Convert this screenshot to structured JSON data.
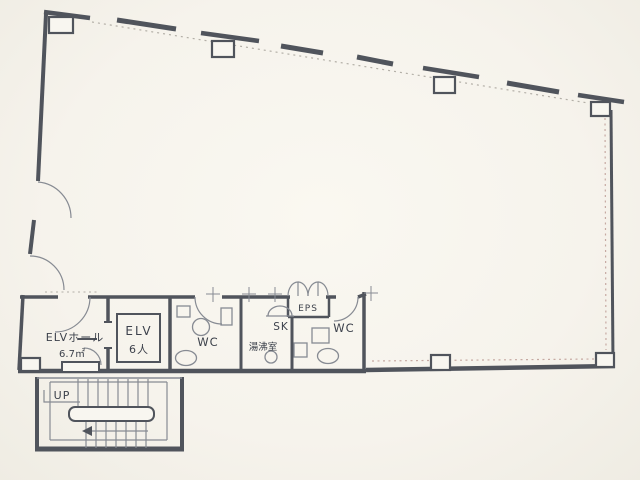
{
  "plan": {
    "kind": "floor-plan",
    "rooms": {
      "elv_hall": {
        "label": "ELVホール",
        "area": "6.7㎡"
      },
      "elevator": {
        "label": "ELV",
        "capacity": "6人"
      },
      "wc_left": {
        "label": "WC"
      },
      "slop_sink": {
        "label": "SK"
      },
      "kitchenette": {
        "label": "湯沸室"
      },
      "eps": {
        "label": "EPS"
      },
      "wc_right": {
        "label": "WC"
      },
      "stairs": {
        "label": "UP"
      }
    },
    "colors": {
      "paper": "#f6f3ec",
      "wall": "#50545c",
      "fixture": "#878b93",
      "dotted_boundary": "#b3afa7",
      "dotted_accent": "#c6a9a2",
      "text": "#3c414b"
    }
  }
}
